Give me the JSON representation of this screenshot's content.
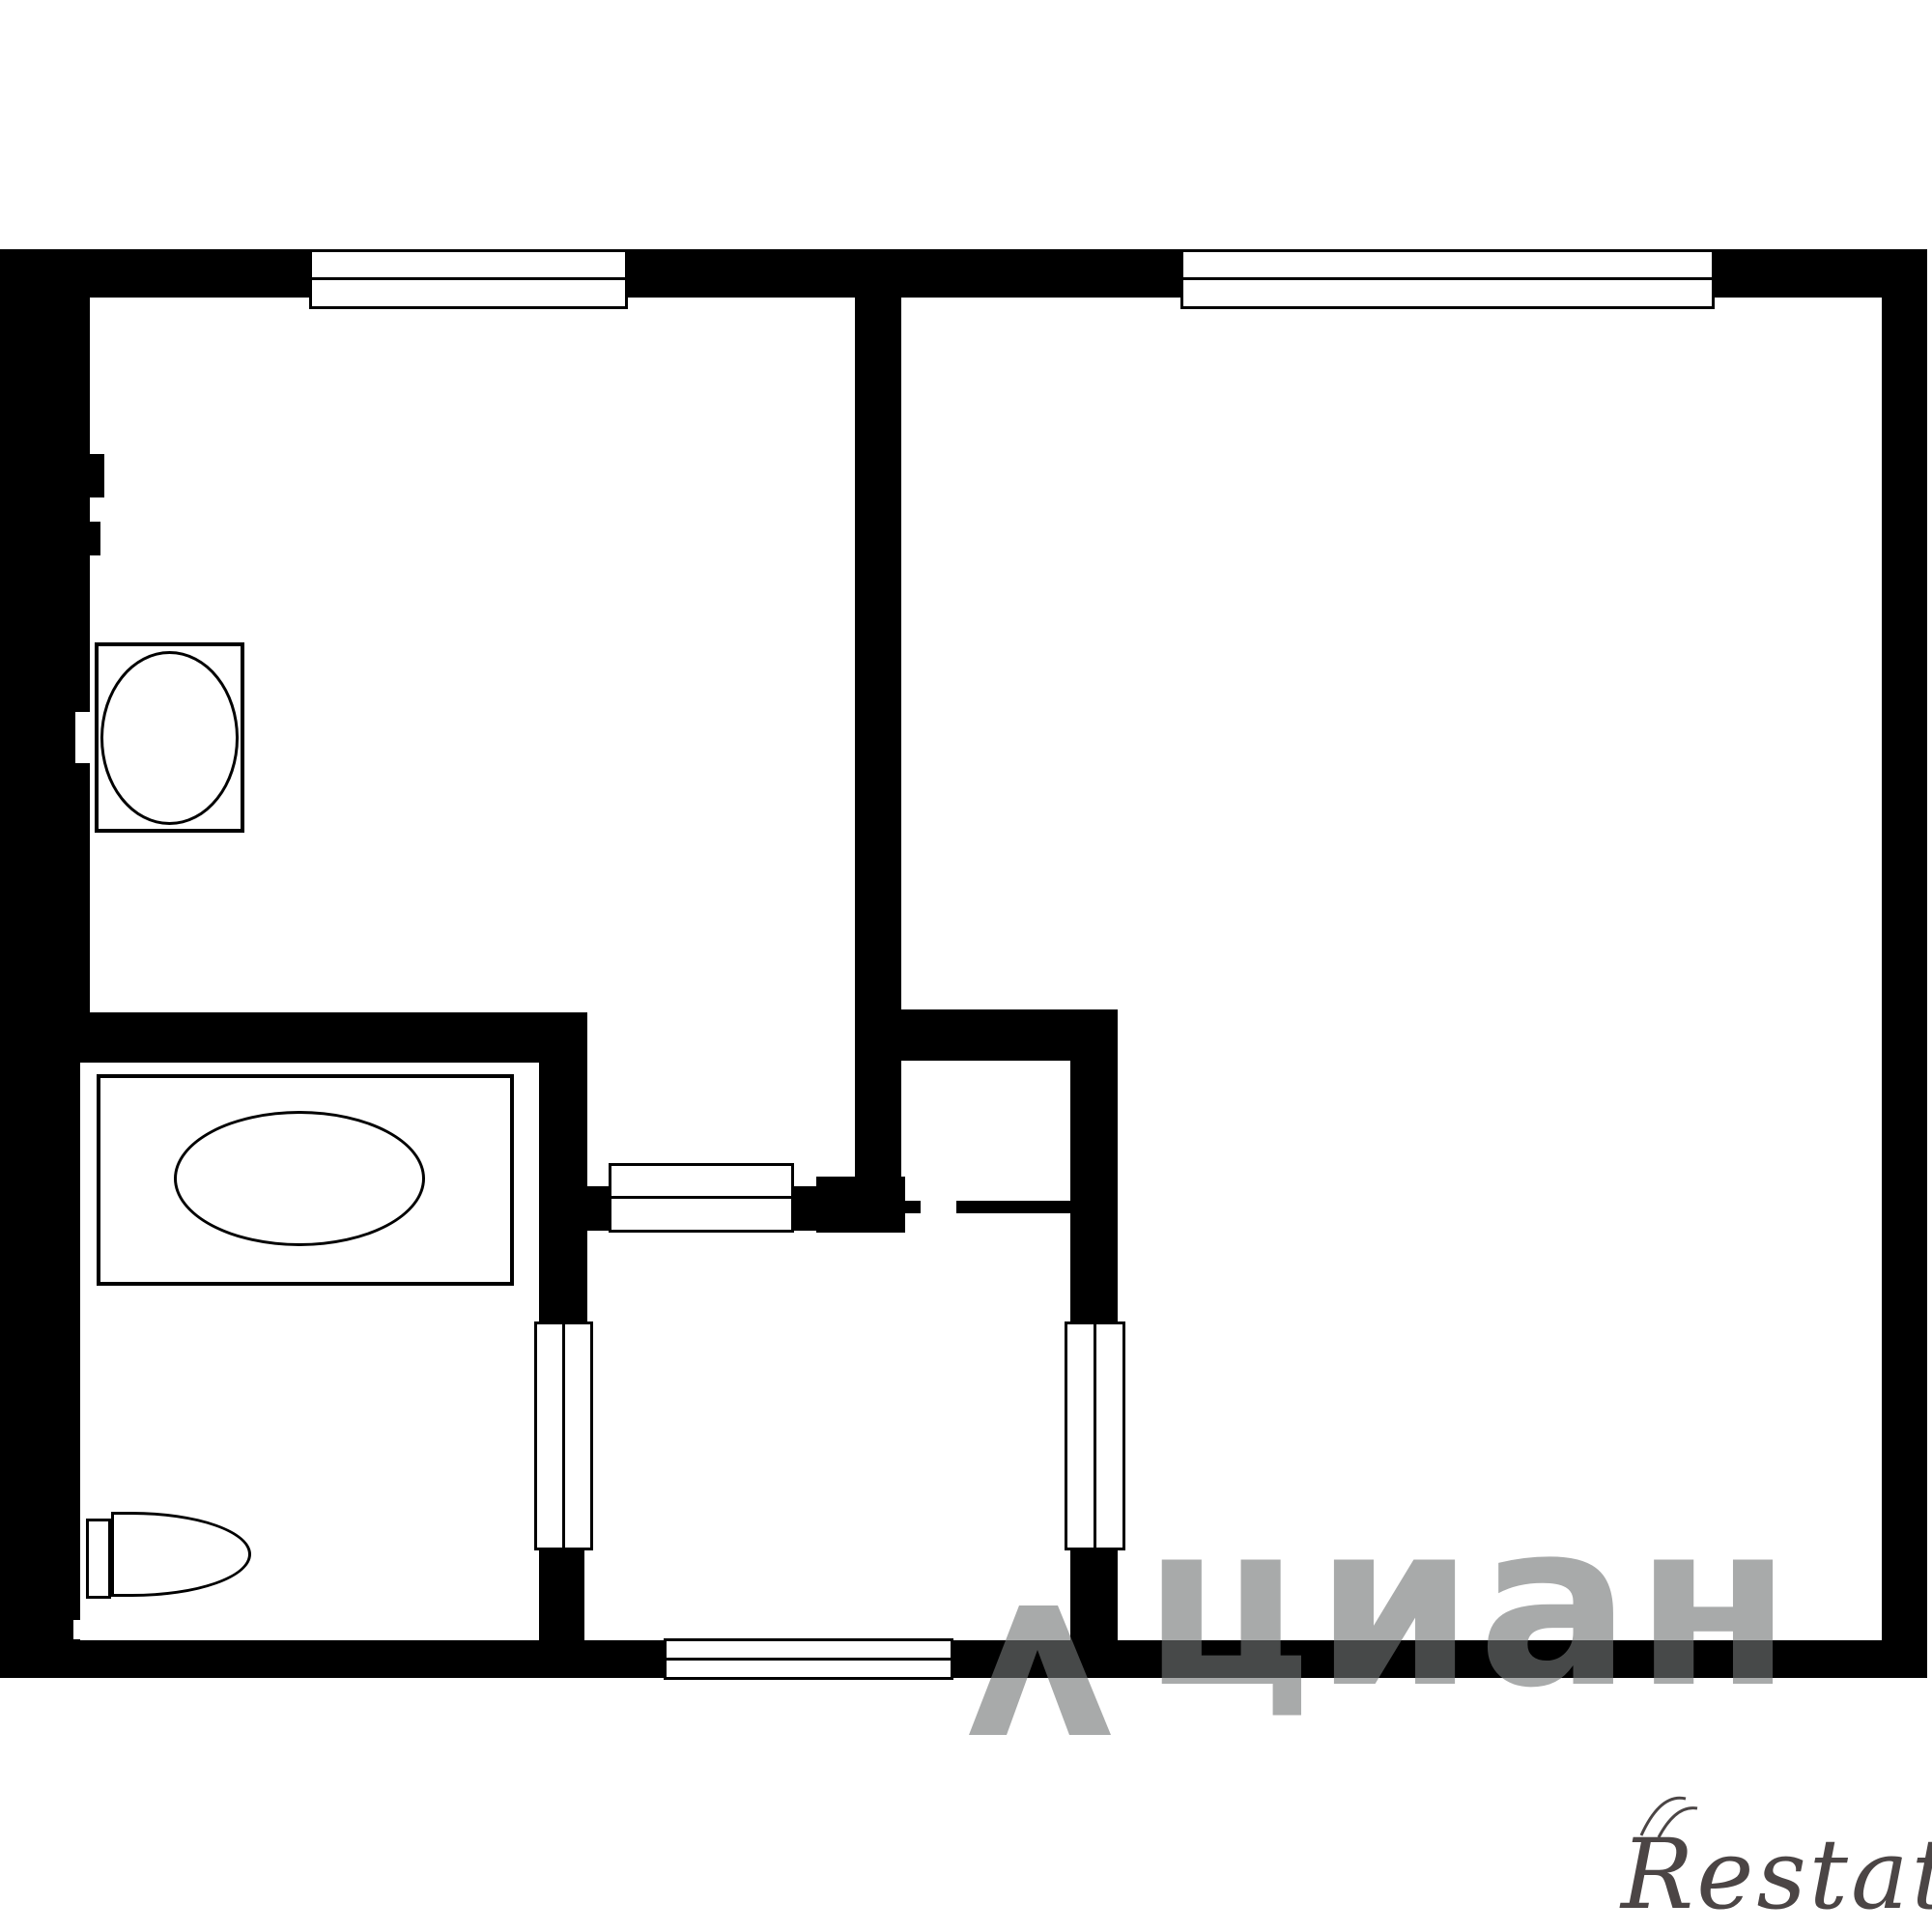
{
  "plan": {
    "type_label": "apartment floor plan",
    "background_color": "#ffffff",
    "wall_color": "#000000",
    "rooms": {
      "top_left": "kitchen",
      "top_right": "living-room",
      "middle_left": "bathroom-with-tub",
      "bottom_left": "toilet-area",
      "bottom_center": "hallway",
      "center": "closet-niche"
    },
    "fixtures": [
      "stove-oval-icon",
      "bathtub-icon",
      "toilet-icon"
    ],
    "openings": [
      "window-top-left",
      "window-top-right",
      "entry-door-bottom",
      "kitchen-door",
      "bathroom-door",
      "living-room-door"
    ]
  },
  "watermarks": {
    "cian": {
      "text": "циан",
      "icon": "map-pin-icon",
      "color": "#9aa0a0"
    },
    "restate": {
      "text": "Restate",
      "icon": "double-arc-icon",
      "color": "#4b4545"
    }
  }
}
